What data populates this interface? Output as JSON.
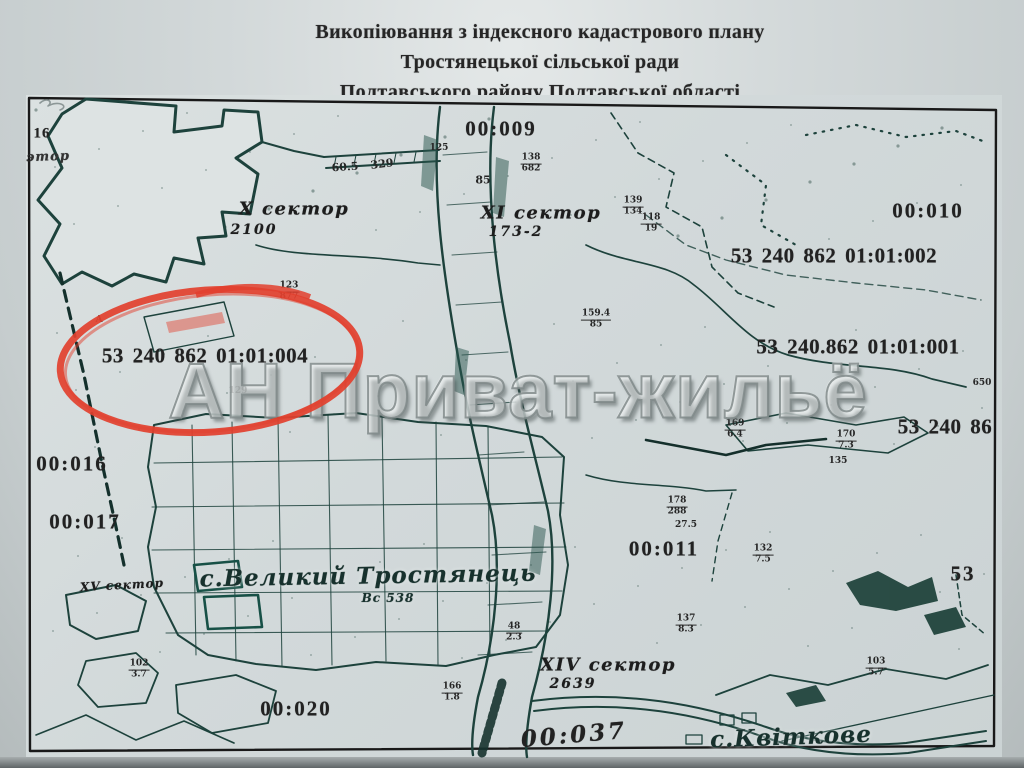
{
  "title": {
    "line1": "Викопіювання з індексного кадастрового плану",
    "line2": "Тростянецької сільської ради",
    "line3": "Полтавського району Полтавської області"
  },
  "watermark": {
    "text": "АН Приват-жильё"
  },
  "highlight": {
    "color": "#e2402e"
  },
  "colors": {
    "paper": "#d2d9da",
    "map_ink": "#1d423c",
    "label_ink": "#222222",
    "highlight_red": "#e2402e",
    "watermark_gray": "#8f9898"
  },
  "map": {
    "zone_labels": [
      {
        "text": "00:009",
        "x": 475,
        "y": 34
      },
      {
        "text": "00:010",
        "x": 902,
        "y": 116
      },
      {
        "text": "00:016",
        "x": 46,
        "y": 369
      },
      {
        "text": "00:017",
        "x": 59,
        "y": 427
      },
      {
        "text": "00:011",
        "x": 638,
        "y": 454
      },
      {
        "text": "00:020",
        "x": 270,
        "y": 614
      },
      {
        "text": "00:037",
        "x": 548,
        "y": 640,
        "cls": "hand",
        "rot": -5
      },
      {
        "text": "53",
        "x": 937,
        "y": 479
      },
      {
        "text": "16",
        "x": 16,
        "y": 39,
        "cls": "small"
      },
      {
        "text": "этор",
        "x": 22,
        "y": 62,
        "cls": "hand-small",
        "rot": -2
      }
    ],
    "cadastral_numbers": [
      {
        "text": "53 240 862 01:01:002",
        "x": 808,
        "y": 161
      },
      {
        "text": "53 240.862 01:01:001",
        "x": 832,
        "y": 252
      },
      {
        "text": "53 240 86",
        "x": 919,
        "y": 332
      },
      {
        "text": "53 240 862 01:01:004",
        "x": 179,
        "y": 261
      }
    ],
    "sector_labels": [
      {
        "text": "X сектор",
        "x": 268,
        "y": 114
      },
      {
        "text": "2100",
        "x": 228,
        "y": 135,
        "cls": "num"
      },
      {
        "text": "XI сектор",
        "x": 515,
        "y": 118
      },
      {
        "text": "173-2",
        "x": 490,
        "y": 137,
        "cls": "num"
      },
      {
        "text": "XIV сектор",
        "x": 582,
        "y": 570
      },
      {
        "text": "2639",
        "x": 547,
        "y": 589,
        "cls": "num"
      },
      {
        "text": "XV сектор",
        "x": 96,
        "y": 490,
        "cls": "xs",
        "rot": -3
      }
    ],
    "settlement_labels": [
      {
        "text": "с.Великий Тростянець",
        "x": 342,
        "y": 481,
        "rot": -1
      },
      {
        "text": "Вс 538",
        "x": 362,
        "y": 503,
        "cls": "sub"
      },
      {
        "text": "с.Квіткове",
        "x": 765,
        "y": 642,
        "rot": -2
      }
    ],
    "tiny_labels": [
      {
        "text": "125",
        "x": 413,
        "y": 53
      },
      {
        "text": "85",
        "x": 457,
        "y": 85,
        "cls": "med"
      },
      {
        "text": "60.5",
        "x": 319,
        "y": 72,
        "cls": "med",
        "rot": -4
      },
      {
        "text": "329",
        "x": 356,
        "y": 69,
        "cls": "med",
        "rot": -7
      },
      {
        "text": "27.5",
        "x": 660,
        "y": 430
      },
      {
        "text": "129",
        "x": 212,
        "y": 296
      },
      {
        "text": "650",
        "x": 956,
        "y": 288
      },
      {
        "text": "135",
        "x": 812,
        "y": 366
      },
      {
        "text": "А",
        "x": 73,
        "y": 225
      }
    ],
    "fractions": [
      {
        "num": "138",
        "den": "682",
        "x": 505,
        "y": 69
      },
      {
        "num": "139",
        "den": "134",
        "x": 607,
        "y": 112
      },
      {
        "num": "118",
        "den": "19",
        "x": 625,
        "y": 129
      },
      {
        "num": "123",
        "den": "877",
        "x": 263,
        "y": 197
      },
      {
        "num": "159.4",
        "den": "85",
        "x": 570,
        "y": 225
      },
      {
        "num": "169",
        "den": "6.4",
        "x": 709,
        "y": 335
      },
      {
        "num": "170",
        "den": "7.3",
        "x": 820,
        "y": 346
      },
      {
        "num": "178",
        "den": "288",
        "x": 651,
        "y": 412
      },
      {
        "num": "132",
        "den": "7.5",
        "x": 737,
        "y": 460
      },
      {
        "num": "137",
        "den": "8.3",
        "x": 660,
        "y": 530
      },
      {
        "num": "48",
        "den": "2.3",
        "x": 488,
        "y": 538
      },
      {
        "num": "166",
        "den": "1.8",
        "x": 426,
        "y": 598
      },
      {
        "num": "102",
        "den": "3.7",
        "x": 113,
        "y": 575
      },
      {
        "num": "103",
        "den": "5.7",
        "x": 850,
        "y": 573
      }
    ]
  }
}
